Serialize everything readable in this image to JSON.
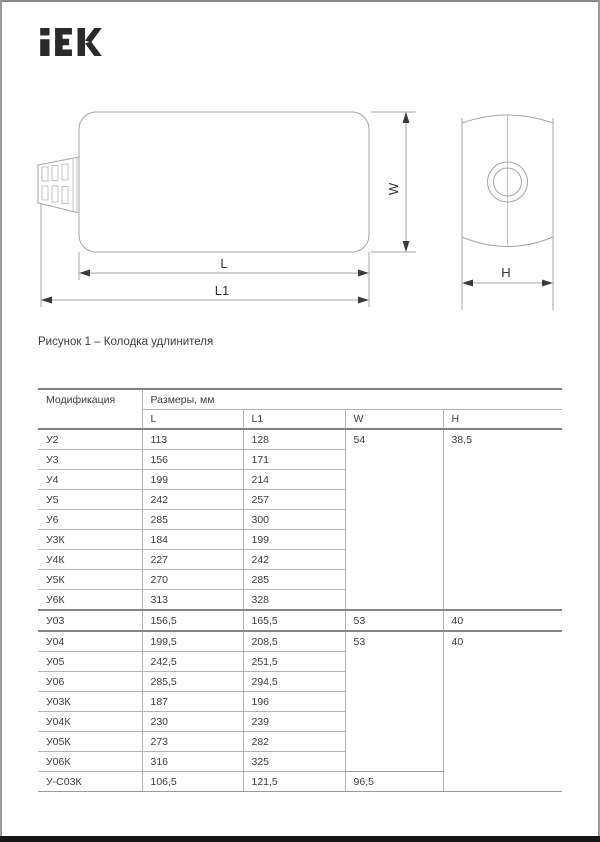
{
  "brand": {
    "logo_text": "IEK"
  },
  "figure": {
    "caption": "Рисунок 1 – Колодка удлинителя",
    "labels": {
      "l": "L",
      "l1": "L1",
      "w": "W",
      "h": "H"
    }
  },
  "table": {
    "modification_header": "Модификация",
    "dimensions_header": "Размеры, мм",
    "columns": [
      "L",
      "L1",
      "W",
      "H"
    ],
    "rows": [
      {
        "mod": "У2",
        "l": "113",
        "l1": "128",
        "w": {
          "v": "54",
          "span": 9
        },
        "h": {
          "v": "38,5",
          "span": 9
        }
      },
      {
        "mod": "У3",
        "l": "156",
        "l1": "171"
      },
      {
        "mod": "У4",
        "l": "199",
        "l1": "214"
      },
      {
        "mod": "У5",
        "l": "242",
        "l1": "257"
      },
      {
        "mod": "У6",
        "l": "285",
        "l1": "300"
      },
      {
        "mod": "У3К",
        "l": "184",
        "l1": "199"
      },
      {
        "mod": "У4К",
        "l": "227",
        "l1": "242"
      },
      {
        "mod": "У5К",
        "l": "270",
        "l1": "285"
      },
      {
        "mod": "У6К",
        "l": "313",
        "l1": "328"
      },
      {
        "mod": "У03",
        "l": "156,5",
        "l1": "165,5",
        "w": {
          "v": "53",
          "span": 1
        },
        "h": {
          "v": "40",
          "span": 1
        },
        "sep": true
      },
      {
        "mod": "У04",
        "l": "199,5",
        "l1": "208,5",
        "w": {
          "v": "53",
          "span": 7
        },
        "h": {
          "v": "40",
          "span": 8
        },
        "sep": true
      },
      {
        "mod": "У05",
        "l": "242,5",
        "l1": "251,5"
      },
      {
        "mod": "У06",
        "l": "285,5",
        "l1": "294,5"
      },
      {
        "mod": "У03К",
        "l": "187",
        "l1": "196"
      },
      {
        "mod": "У04К",
        "l": "230",
        "l1": "239"
      },
      {
        "mod": "У05К",
        "l": "273",
        "l1": "282"
      },
      {
        "mod": "У06К",
        "l": "316",
        "l1": "325"
      },
      {
        "mod": "У-С03К",
        "l": "106,5",
        "l1": "121,5",
        "w": {
          "v": "96,5",
          "span": 1
        }
      }
    ]
  }
}
